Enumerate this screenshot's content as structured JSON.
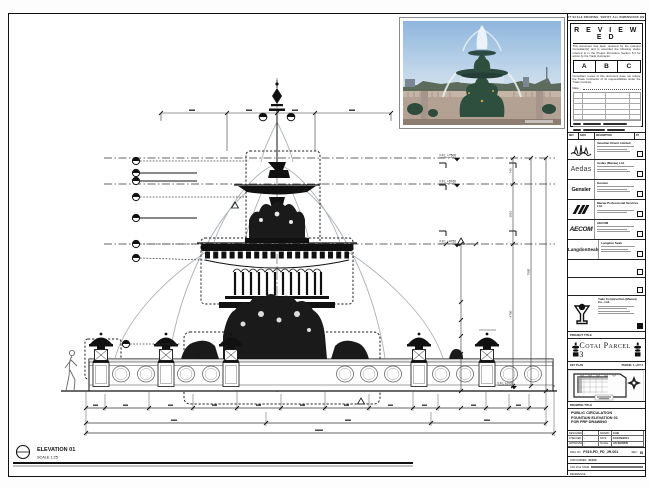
{
  "notes_strip": "DO NOT SCALE DRAWING. VERIFY ALL DIMENSIONS ON SITE.",
  "stamp": {
    "title": "R E V I E W E D",
    "body1": "This document has been received by the relevant Consultant(s) and is accorded the following status referred to in the Project Procedure Section 5.4 for action by the Trade Contractor.",
    "grades": [
      "A",
      "B",
      "C"
    ],
    "body2": "Consultant review of this document does not relieve the Trade Contractor of its responsibilities under the Trade Contract.",
    "date_label": "Date :"
  },
  "revision_header": {
    "rev": "REV",
    "date": "DATE",
    "description": "DESCRIPTION",
    "by": "BY"
  },
  "consultants": [
    {
      "name": "Venetian Orient Limited",
      "logo_text": ""
    },
    {
      "name": "Aedas (Macau) Ltd.",
      "logo_text": "Aedas"
    },
    {
      "name": "Gensler",
      "logo_text": "Gensler"
    },
    {
      "name": "Macau Professional Services Ltd.",
      "logo_text": ""
    },
    {
      "name": "AECOM",
      "logo_text": "AECOM"
    },
    {
      "name": "Langdon Seah",
      "logo_text": "LangdonSeah"
    }
  ],
  "contractor": {
    "name": "Yuke Construction (Macau) Co., Ltd."
  },
  "project": {
    "label": "PROJECT TITLE",
    "title": "Cotai Parcel 3"
  },
  "key_plan": {
    "label": "KEY PLAN",
    "parcel": "PARCEL 1, LOT 3"
  },
  "drawing": {
    "label": "DRAWING TITLE",
    "title": "PUBLIC CIRCULATION\nFOUNTAIN ELEVATION 01\nFOR FRP DRAWING"
  },
  "fields": {
    "designed_label": "DESIGNED",
    "designed": "-",
    "checked_label": "CHECKED",
    "checked": "-",
    "approved_label": "APPROVED",
    "approved": "-",
    "drawn_label": "DRAWN",
    "drawn": "CAD",
    "date_label": "DATE",
    "date": "10/JAN/2014",
    "scale_label": "SCALE",
    "scale": "AS SHOWN"
  },
  "numbers": {
    "dwg_label": "DWG NO.",
    "dwg": "P315-PD_FD_JR-001",
    "rev_label": "REV :",
    "rev": "B",
    "job_label": "JOB NUMBER",
    "job": "31103",
    "cad_label": "CAD FILE NAME",
    "ref_label": "REFERENCE"
  },
  "viewport": {
    "title": "ELEVATION 01",
    "scale": "SCALE  1:25"
  },
  "levels": [
    "F.F.L +7500",
    "F.F.L +6760",
    "F.F.L +4750",
    "F.F.L ±0.00"
  ],
  "dims": {
    "right": [
      "740",
      "2010",
      "4750",
      "7500"
    ]
  }
}
